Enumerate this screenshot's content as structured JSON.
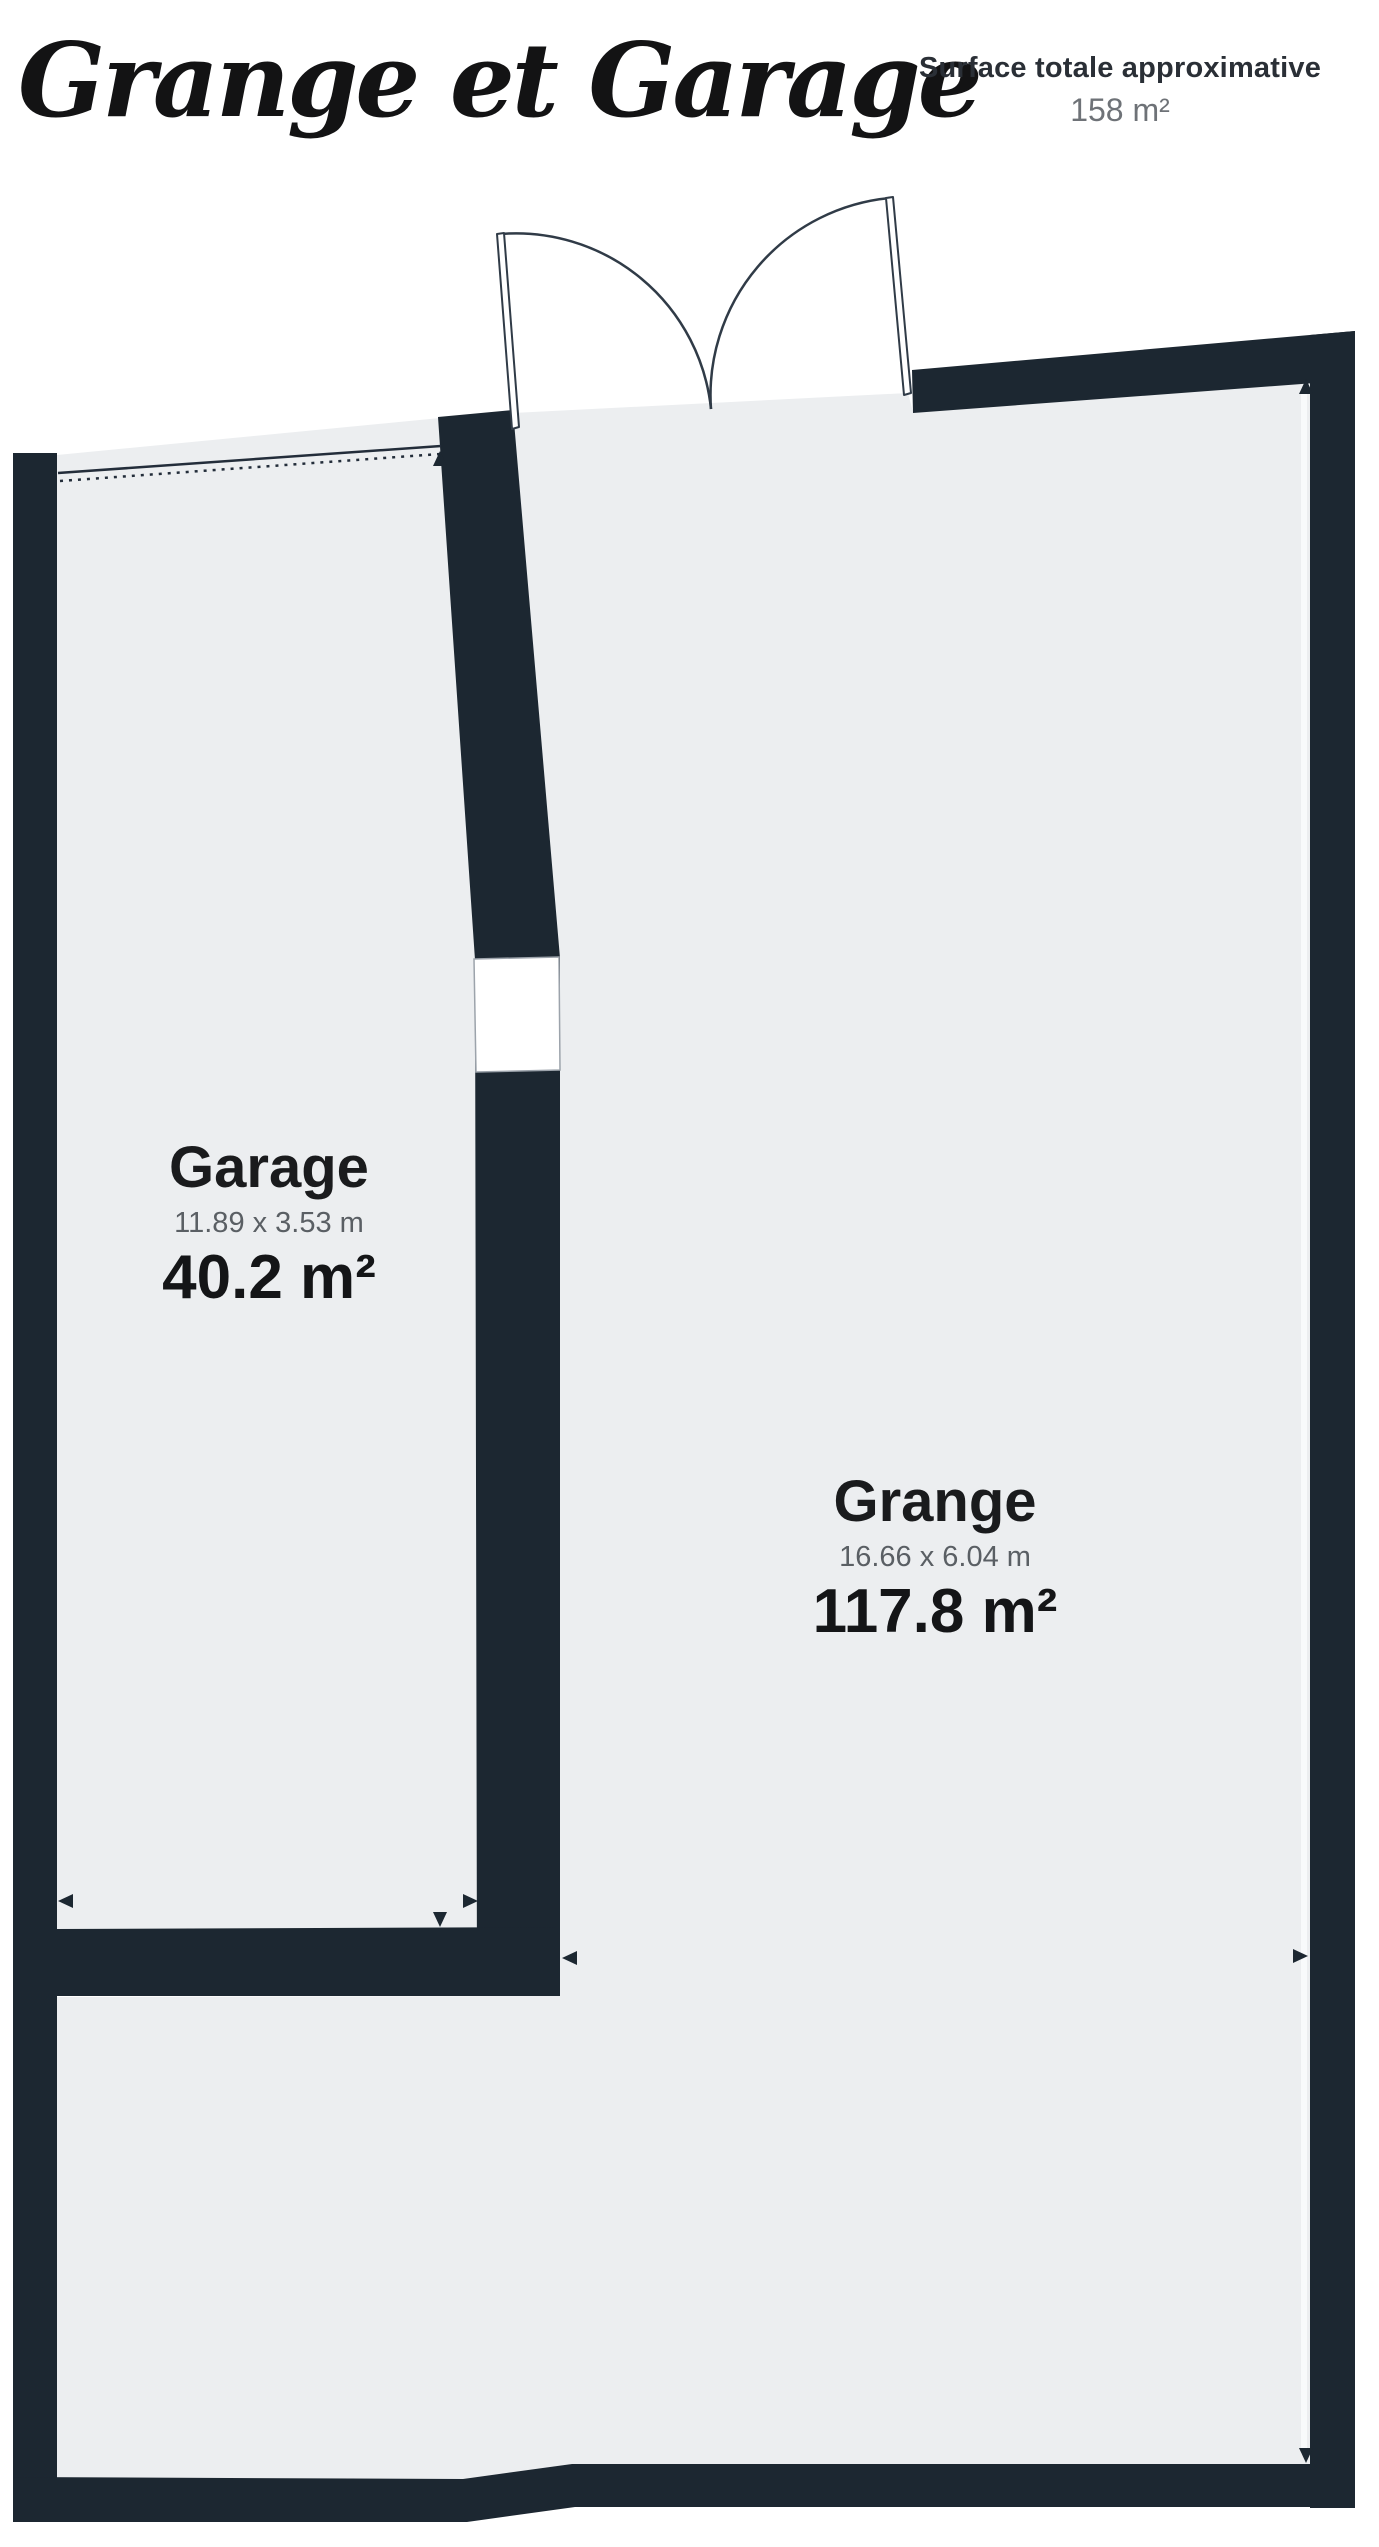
{
  "header": {
    "title": "Grange et Garage",
    "surface_label": "Surface totale approximative",
    "surface_value": "158 m²"
  },
  "rooms": [
    {
      "id": "garage",
      "name": "Garage",
      "dimensions": "11.89 x 3.53 m",
      "area": "40.2 m²"
    },
    {
      "id": "grange",
      "name": "Grange",
      "dimensions": "16.66 x 6.04 m",
      "area": "117.8 m²"
    }
  ],
  "colors": {
    "wall": "#1C2731",
    "floor": "#ECEEF0",
    "door_line": "#303B47",
    "gap_border": "#9CA3AB",
    "text_dark": "#1A1B1D",
    "text_gray": "#5A5F64"
  }
}
